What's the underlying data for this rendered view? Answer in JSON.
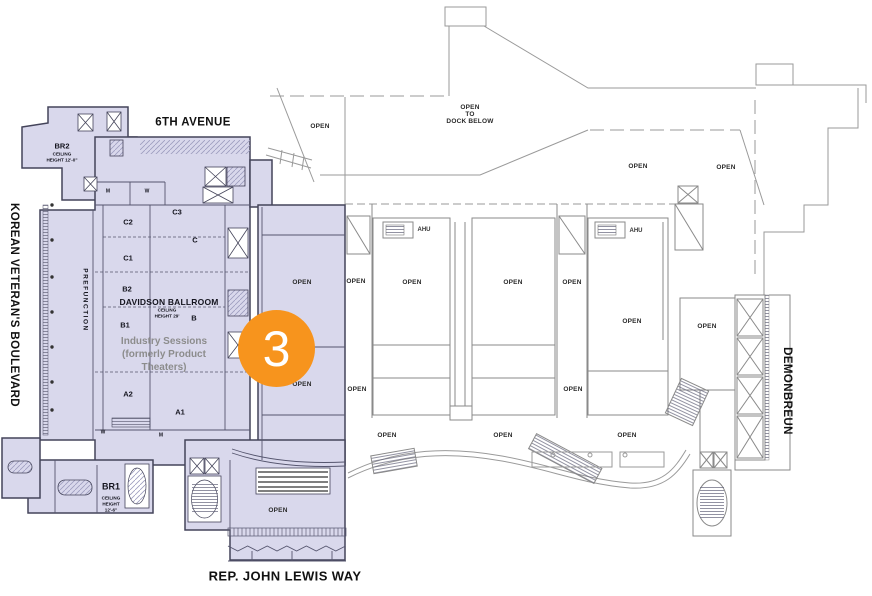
{
  "streets": {
    "top": "6TH AVENUE",
    "left": "KOREAN VETERAN'S BOULEVARD",
    "right": "DEMONBREUN",
    "bottom": "REP. JOHN LEWIS WAY"
  },
  "marker": {
    "number": "3"
  },
  "zones": {
    "prefunction": "PREFUNCTION",
    "ballroom": {
      "name": "DAVIDSON BALLROOM",
      "ceiling": [
        "CEILING",
        "HEIGHT 29'"
      ],
      "section": "B",
      "note": [
        "Industry Sessions",
        "(formerly Product",
        "Theaters)"
      ]
    },
    "sections": [
      "C2",
      "C3",
      "C",
      "C1",
      "B2",
      "B1",
      "A2",
      "A1"
    ],
    "boardroom2": {
      "name": "BR2",
      "ceiling": [
        "CEILING",
        "HEIGHT 12'-0\""
      ]
    },
    "boardroom1": {
      "name": "BR1",
      "ceiling": [
        "CEILING",
        "HEIGHT",
        "12'-6\""
      ]
    },
    "restrooms": [
      "M",
      "W",
      "W",
      "M"
    ]
  },
  "plan_labels": {
    "open": "OPEN",
    "open_to_dock": [
      "OPEN",
      "TO",
      "DOCK BELOW"
    ],
    "ahu": "AHU"
  },
  "colors": {
    "highlight_fill": "#D9D8EC",
    "highlight_wall": "#44445A",
    "plan_gray": "#9A9A9A",
    "marker_orange": "#F7941D",
    "note_gray": "#8C8C8C"
  }
}
